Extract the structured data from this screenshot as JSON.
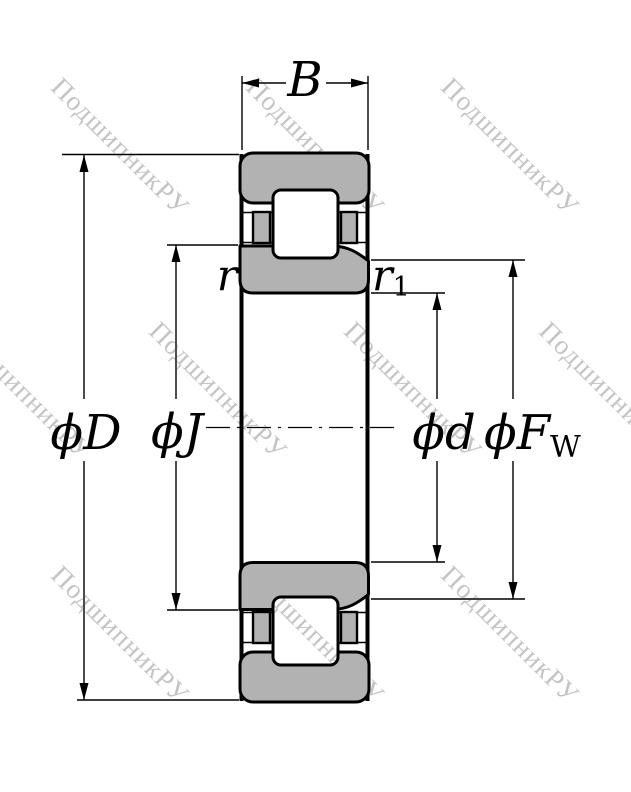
{
  "watermark": {
    "text": "ПодшипникРУ",
    "color": "#c4c4c4"
  },
  "colors": {
    "background": "#ffffff",
    "metal_fill": "#b2b2b2",
    "line": "#000000"
  },
  "labels": {
    "width": "B",
    "outer_diameter": "ϕD",
    "flange_diameter": "ϕJ",
    "bore_diameter": "ϕd",
    "raceway_diameter": "ϕF",
    "raceway_diameter_sub": "W",
    "chamfer_outer": "r",
    "chamfer_inner": "r",
    "chamfer_inner_sub": "1"
  }
}
